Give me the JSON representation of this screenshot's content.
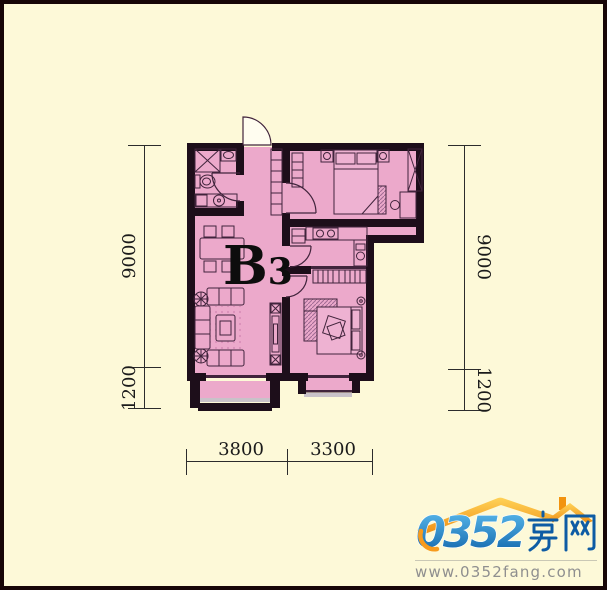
{
  "plan": {
    "unit_label": "B3",
    "unit_label_main": "B",
    "unit_label_sub": "3",
    "rooms_depicted": [
      "bathroom",
      "entry-hall",
      "master-bedroom",
      "kitchen",
      "living-dining-room",
      "second-bedroom",
      "living-room-balcony",
      "bedroom-balcony"
    ]
  },
  "dimensions": {
    "left_upper": "9000",
    "left_lower": "1200",
    "right_upper": "9000",
    "right_lower": "1200",
    "bottom_left": "3800",
    "bottom_right": "3300"
  },
  "logo": {
    "brand_number": "0352",
    "brand_cjk": "房网",
    "website": "www.0352fang.com"
  },
  "colors": {
    "background": "#fdf9d8",
    "floor_pink": "#eca9cb",
    "wall": "#1d0e1a",
    "brand_blue": "#1b7fc6",
    "brand_orange": "#f79b1e"
  }
}
